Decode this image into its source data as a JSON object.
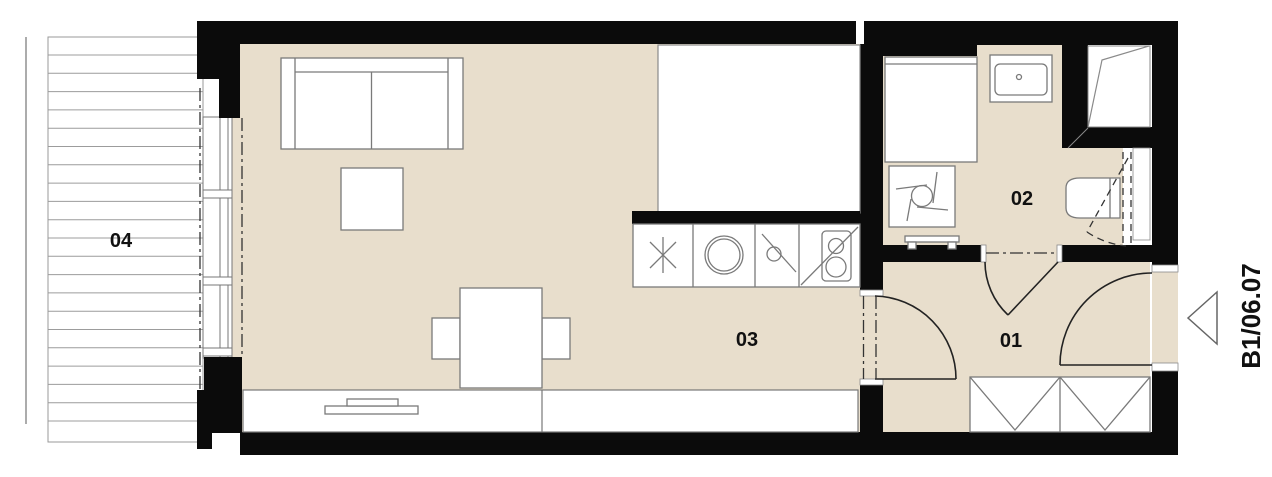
{
  "labels": {
    "room01": "01",
    "room02": "02",
    "room03": "03",
    "room04": "04"
  },
  "unit_marker": {
    "label": "B1/06.07"
  },
  "colors": {
    "floor": "#e8decc",
    "wall": "#0b0b0b",
    "line": "#7a7a7a",
    "door": "#222222",
    "label": "#111111",
    "hatch": "#9c9c9c",
    "background": "#ffffff"
  }
}
